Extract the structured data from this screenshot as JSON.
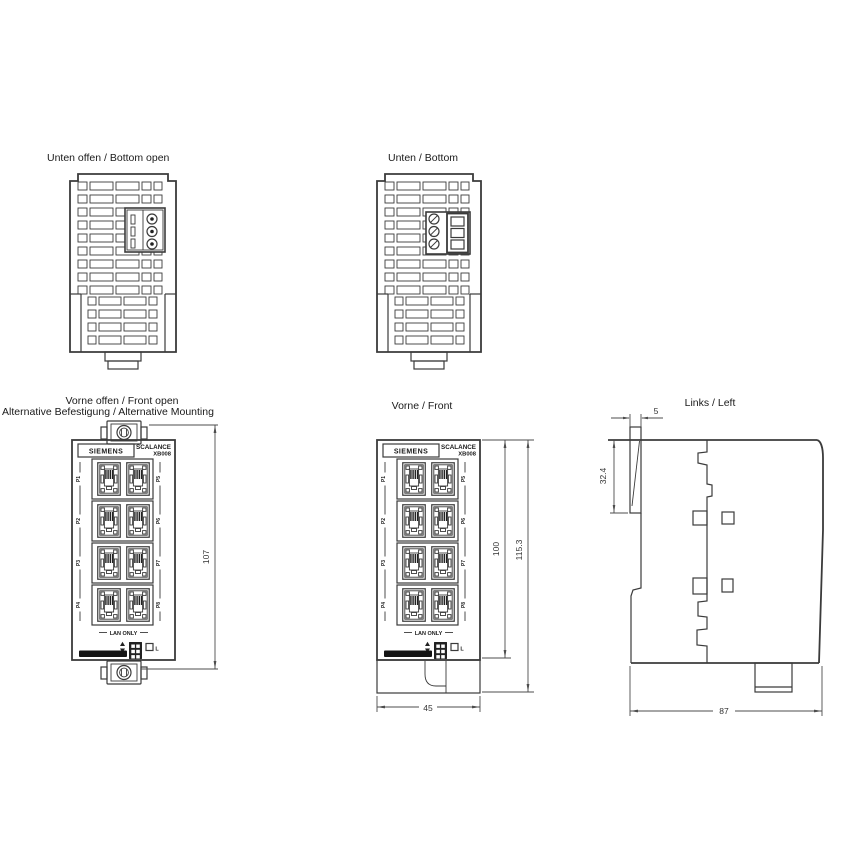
{
  "views": {
    "bottom_open": {
      "title": "Unten offen / Bottom open"
    },
    "bottom": {
      "title": "Unten / Bottom"
    },
    "front_open": {
      "title_line1": "Vorne offen / Front open",
      "title_line2": "Alternative Befestigung / Alternative Mounting"
    },
    "front": {
      "title": "Vorne / Front"
    },
    "left": {
      "title": "Links / Left"
    }
  },
  "device": {
    "brand": "SIEMENS",
    "product_line": "SCALANCE",
    "model": "XB008",
    "lan_only_label": "LAN ONLY",
    "link_led_label": "L"
  },
  "ports": {
    "left_column": [
      "P1",
      "P2",
      "P3",
      "P4"
    ],
    "right_column": [
      "P5",
      "P6",
      "P7",
      "P8"
    ]
  },
  "dimensions_mm": {
    "front_open_mounting_height": "107",
    "front_body_height": "100",
    "front_total_height": "115.3",
    "front_width": "45",
    "left_flange_thickness": "5",
    "left_flange_height": "32.4",
    "left_depth": "87"
  },
  "colors": {
    "line": "#3b3b3b",
    "dimension": "#4d4d4d",
    "text": "#1a1a1a",
    "background": "#ffffff"
  }
}
